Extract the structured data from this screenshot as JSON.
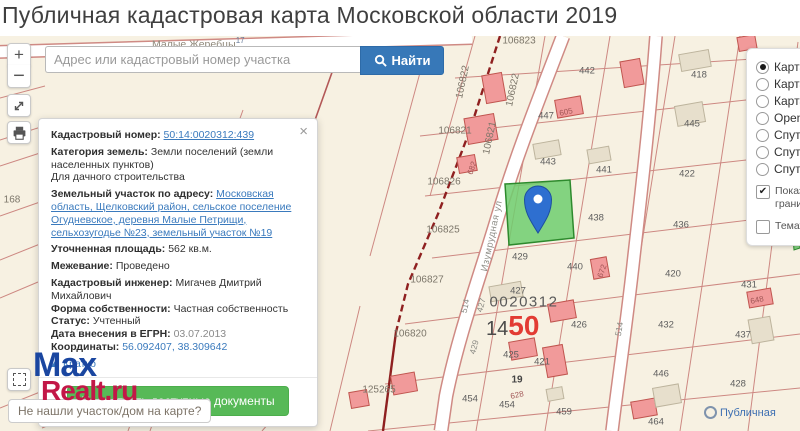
{
  "header": {
    "title": "Публичная кадастровая карта Московской области 2019"
  },
  "search": {
    "placeholder": "Адрес или кадастровый номер участка",
    "button": "Найти"
  },
  "controls": {
    "zoom_in": "+",
    "zoom_out": "−"
  },
  "popup": {
    "close": "×",
    "cadastral_number_label": "Кадастровый номер:",
    "cadastral_number": "50:14:0020312:439",
    "category_label": "Категория земель:",
    "category": "Земли поселений (земли населенных пунктов)",
    "purpose": "Для дачного строительства",
    "address_label": "Земельный участок по адресу:",
    "address": "Московская область, Щелковский район, сельское поселение Огудневское, деревня Малые Петрищи, сельхозугодье №23, земельный участок №19",
    "area_label": "Уточненная площадь:",
    "area": "562 кв.м.",
    "survey_label": "Межевание:",
    "survey": "Проведено",
    "engineer_label": "Кадастровый инженер:",
    "engineer": "Мигачев Дмитрий Михайлович",
    "ownership_label": "Форма собственности:",
    "ownership": "Частная собственность",
    "status_label": "Статус:",
    "status": "Учтенный",
    "egrn_label": "Дата внесения в ЕГРН:",
    "egrn_date": "03.07.2013",
    "coords_label": "Координаты:",
    "coords": "56.092407, 38.309642",
    "collapse_link": "Кратко",
    "documents_button": "Посмотреть доступные документы"
  },
  "layers": {
    "options": [
      "Карта Я",
      "Карта G",
      "Карта 2",
      "OpenSt",
      "Спутни",
      "Спутни",
      "Спутни"
    ],
    "selected_index": 0,
    "show_borders": "Показать границы",
    "show_borders_check": "✔",
    "thematic": "Темати"
  },
  "logo": {
    "part1": "Max",
    "part2": "Realt.ru"
  },
  "tooltip": {
    "text": "Не нашли участок/дом на карте?"
  },
  "attribution": {
    "text": "Публичная"
  },
  "map": {
    "place_label": "Малые Жеребцы",
    "place_sup": "17",
    "zoom_badge": {
      "small": "14",
      "big": "50"
    },
    "labels": [
      {
        "text": "106823",
        "x": 519,
        "y": 5,
        "cls": "quarter"
      },
      {
        "text": "442",
        "x": 587,
        "y": 35
      },
      {
        "text": "418",
        "x": 699,
        "y": 39
      },
      {
        "text": "447",
        "x": 546,
        "y": 80
      },
      {
        "text": "445",
        "x": 692,
        "y": 88
      },
      {
        "text": "443",
        "x": 548,
        "y": 126
      },
      {
        "text": "441",
        "x": 604,
        "y": 134
      },
      {
        "text": "422",
        "x": 687,
        "y": 138
      },
      {
        "text": "436",
        "x": 681,
        "y": 189
      },
      {
        "text": "433",
        "x": 755,
        "y": 200
      },
      {
        "text": "106821",
        "x": 455,
        "y": 95,
        "cls": "quarter"
      },
      {
        "text": "106822",
        "x": 463,
        "y": 46,
        "rot": -78,
        "cls": "quarter"
      },
      {
        "text": "106822",
        "x": 513,
        "y": 54,
        "rot": -78,
        "cls": "quarter"
      },
      {
        "text": "106821",
        "x": 490,
        "y": 102,
        "rot": -78,
        "cls": "quarter"
      },
      {
        "text": "106826",
        "x": 444,
        "y": 146,
        "cls": "quarter"
      },
      {
        "text": "106825",
        "x": 443,
        "y": 194,
        "cls": "quarter"
      },
      {
        "text": "106827",
        "x": 427,
        "y": 244,
        "cls": "quarter"
      },
      {
        "text": "106820",
        "x": 410,
        "y": 298,
        "cls": "quarter"
      },
      {
        "text": "125265",
        "x": 379,
        "y": 354,
        "cls": "quarter"
      },
      {
        "text": "168",
        "x": 12,
        "y": 164,
        "cls": "quarter"
      },
      {
        "text": "682",
        "x": 472,
        "y": 132,
        "rot": -70,
        "cls": "bldg"
      },
      {
        "text": "605",
        "x": 566,
        "y": 76,
        "rot": -12,
        "cls": "bldg"
      },
      {
        "text": "672",
        "x": 602,
        "y": 235,
        "rot": -70,
        "cls": "bldg"
      },
      {
        "text": "648",
        "x": 757,
        "y": 264,
        "rot": -12,
        "cls": "bldg"
      },
      {
        "text": "628",
        "x": 517,
        "y": 359,
        "rot": -12,
        "cls": "bldg"
      },
      {
        "text": "429",
        "x": 520,
        "y": 221
      },
      {
        "text": "438",
        "x": 596,
        "y": 182
      },
      {
        "text": "427",
        "x": 518,
        "y": 255
      },
      {
        "text": "427",
        "x": 481,
        "y": 269,
        "rot": -75,
        "cls": "road"
      },
      {
        "text": "429",
        "x": 474,
        "y": 311,
        "rot": -75,
        "cls": "road"
      },
      {
        "text": "514",
        "x": 465,
        "y": 270,
        "rot": -78,
        "cls": "road"
      },
      {
        "text": "514",
        "x": 619,
        "y": 293,
        "rot": -80,
        "cls": "road"
      },
      {
        "text": "425",
        "x": 511,
        "y": 319
      },
      {
        "text": "421",
        "x": 542,
        "y": 326
      },
      {
        "text": "19",
        "x": 517,
        "y": 344,
        "cls": "num-bold"
      },
      {
        "text": "454",
        "x": 470,
        "y": 363
      },
      {
        "text": "454",
        "x": 507,
        "y": 369
      },
      {
        "text": "459",
        "x": 564,
        "y": 376
      },
      {
        "text": "440",
        "x": 575,
        "y": 231
      },
      {
        "text": "420",
        "x": 673,
        "y": 238
      },
      {
        "text": "431",
        "x": 749,
        "y": 249
      },
      {
        "text": "426",
        "x": 579,
        "y": 289
      },
      {
        "text": "432",
        "x": 666,
        "y": 289
      },
      {
        "text": "437",
        "x": 743,
        "y": 299
      },
      {
        "text": "446",
        "x": 661,
        "y": 338
      },
      {
        "text": "428",
        "x": 738,
        "y": 348
      },
      {
        "text": "464",
        "x": 656,
        "y": 386
      },
      {
        "text": "0020312",
        "x": 524,
        "y": 266,
        "cls": "big"
      },
      {
        "text": "Изумрудная ул",
        "x": 492,
        "y": 200,
        "rot": -78,
        "cls": "street"
      }
    ],
    "buildings": [
      {
        "type": "red",
        "x": 622,
        "y": 24,
        "w": 20,
        "h": 26,
        "rot": -10
      },
      {
        "type": "red",
        "x": 556,
        "y": 62,
        "w": 26,
        "h": 18,
        "rot": -10
      },
      {
        "type": "red",
        "x": 484,
        "y": 38,
        "w": 20,
        "h": 28,
        "rot": -10
      },
      {
        "type": "red",
        "x": 466,
        "y": 80,
        "w": 30,
        "h": 26,
        "rot": -10
      },
      {
        "type": "red",
        "x": 458,
        "y": 120,
        "w": 18,
        "h": 16,
        "rot": -10
      },
      {
        "type": "red",
        "x": 549,
        "y": 266,
        "w": 26,
        "h": 18,
        "rot": -10
      },
      {
        "type": "red",
        "x": 545,
        "y": 310,
        "w": 20,
        "h": 30,
        "rot": -10
      },
      {
        "type": "red",
        "x": 748,
        "y": 254,
        "w": 24,
        "h": 16,
        "rot": -10
      },
      {
        "type": "red",
        "x": 632,
        "y": 364,
        "w": 24,
        "h": 17,
        "rot": -10
      },
      {
        "type": "red",
        "x": 592,
        "y": 222,
        "w": 16,
        "h": 20,
        "rot": -10
      },
      {
        "type": "red",
        "x": 510,
        "y": 304,
        "w": 26,
        "h": 18,
        "rot": -10
      },
      {
        "type": "red",
        "x": 392,
        "y": 338,
        "w": 24,
        "h": 19,
        "rot": -10
      },
      {
        "type": "red",
        "x": 350,
        "y": 355,
        "w": 18,
        "h": 16,
        "rot": -10
      },
      {
        "type": "red",
        "x": 738,
        "y": 0,
        "w": 18,
        "h": 14,
        "rot": -10
      },
      {
        "type": "tan",
        "x": 680,
        "y": 16,
        "w": 30,
        "h": 17,
        "rot": -10
      },
      {
        "type": "tan",
        "x": 676,
        "y": 68,
        "w": 28,
        "h": 20,
        "rot": -10
      },
      {
        "type": "tan",
        "x": 534,
        "y": 106,
        "w": 26,
        "h": 15,
        "rot": -10
      },
      {
        "type": "tan",
        "x": 588,
        "y": 112,
        "w": 22,
        "h": 14,
        "rot": -10
      },
      {
        "type": "tan",
        "x": 750,
        "y": 282,
        "w": 22,
        "h": 24,
        "rot": -10
      },
      {
        "type": "tan",
        "x": 654,
        "y": 350,
        "w": 26,
        "h": 19,
        "rot": -10
      },
      {
        "type": "tan",
        "x": 490,
        "y": 248,
        "w": 32,
        "h": 15,
        "rot": -10
      },
      {
        "type": "tan",
        "x": 547,
        "y": 352,
        "w": 16,
        "h": 12,
        "rot": -10
      }
    ]
  },
  "colors": {
    "map_background": "#f7f1e2",
    "parcel_line": "#cb837d",
    "quarter_line": "#8f2020",
    "selected_parcel_fill": "#6fce6f",
    "selected_parcel_stroke": "#2d8a2d",
    "marker_blue": "#2e6fd0",
    "building_red": "#f19a9a",
    "building_tan": "#e7dfcc",
    "primary_button": "#3778b8",
    "success_button": "#57b957",
    "brand_blue": "#1a46a0",
    "brand_red": "#c21747",
    "zoom_badge_red": "#e23b33"
  }
}
